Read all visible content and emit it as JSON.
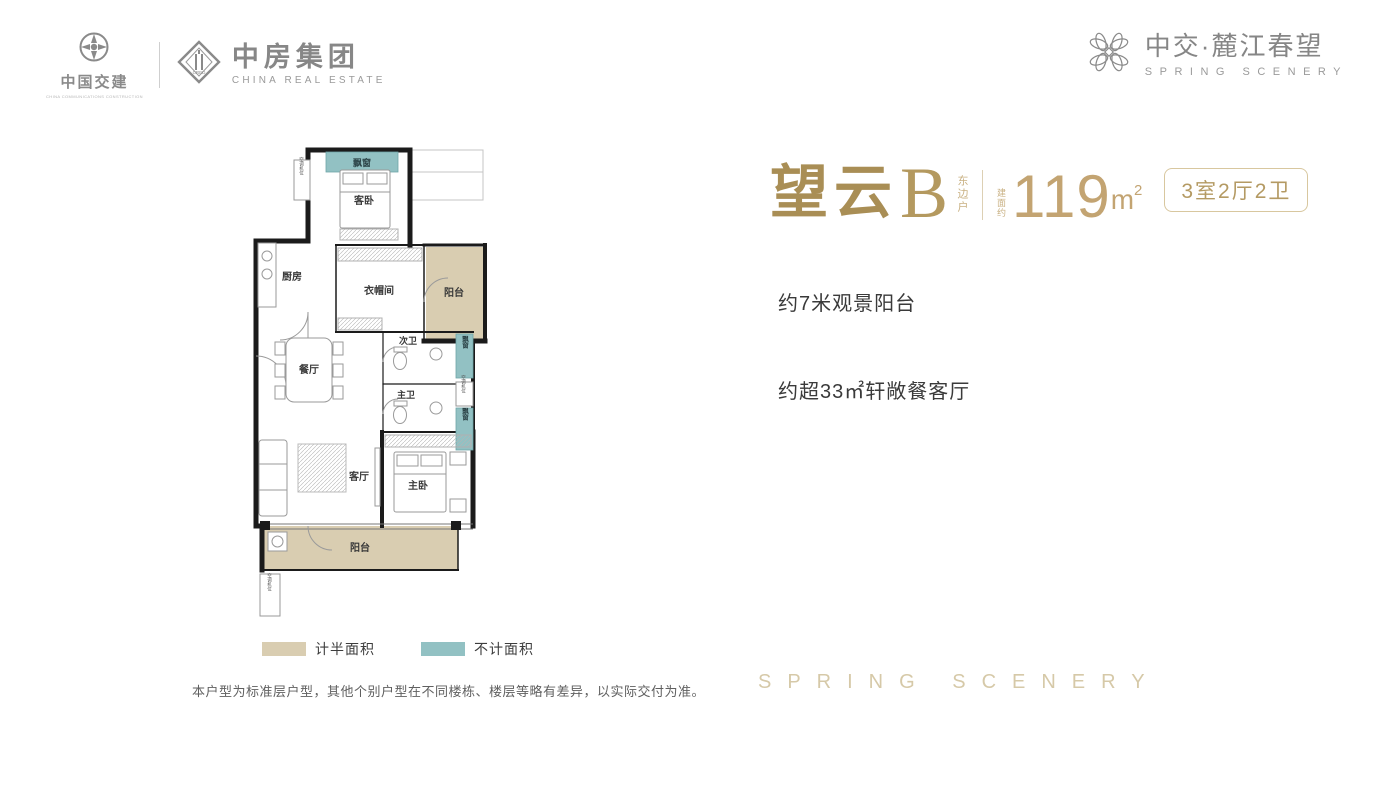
{
  "header": {
    "ccc": {
      "name": "中国交建",
      "subtitle": "CHINA COMMUNICATIONS CONSTRUCTION"
    },
    "cre": {
      "name": "中房集团",
      "subtitle": "CHINA REAL ESTATE",
      "monogram": "CRED"
    },
    "brand": {
      "name": "中交·麓江春望",
      "subtitle": "SPRING SCENERY"
    }
  },
  "unit": {
    "name_zh": "望云",
    "name_letter": "B",
    "side_note": "东边户",
    "area_prefix": "建面约",
    "area_value": "119",
    "area_unit": "m",
    "area_exp": "2",
    "layout_badge": "3室2厅2卫"
  },
  "highlights": [
    "约7米观景阳台",
    "约超33㎡轩敞餐客厅"
  ],
  "plan": {
    "rooms": [
      {
        "id": "bay-top",
        "label": "飘窗"
      },
      {
        "id": "guest-bedroom",
        "label": "客卧"
      },
      {
        "id": "kitchen",
        "label": "厨房"
      },
      {
        "id": "cloakroom",
        "label": "衣帽间"
      },
      {
        "id": "balcony-upper",
        "label": "阳台"
      },
      {
        "id": "dining",
        "label": "餐厅"
      },
      {
        "id": "bath-second",
        "label": "次卫"
      },
      {
        "id": "bath-master",
        "label": "主卫"
      },
      {
        "id": "bay-right-top",
        "label": "飘窗"
      },
      {
        "id": "ac-right",
        "label": "空调机位"
      },
      {
        "id": "bay-right-bottom",
        "label": "飘窗"
      },
      {
        "id": "living",
        "label": "客厅"
      },
      {
        "id": "master-bedroom",
        "label": "主卧"
      },
      {
        "id": "balcony-bottom",
        "label": "阳台"
      },
      {
        "id": "ac-bottom",
        "label": "空调机位"
      },
      {
        "id": "ac-top",
        "label": "空调机位"
      }
    ],
    "colors": {
      "half_area": "#d9cdb1",
      "excluded": "#92c1c3"
    }
  },
  "legend": {
    "half_area": "计半面积",
    "excluded": "不计面积"
  },
  "disclaimer": "本户型为标准层户型，其他个别户型在不同楼栋、楼层等略有差异，以实际交付为准。",
  "watermark": "SPRING SCENERY"
}
